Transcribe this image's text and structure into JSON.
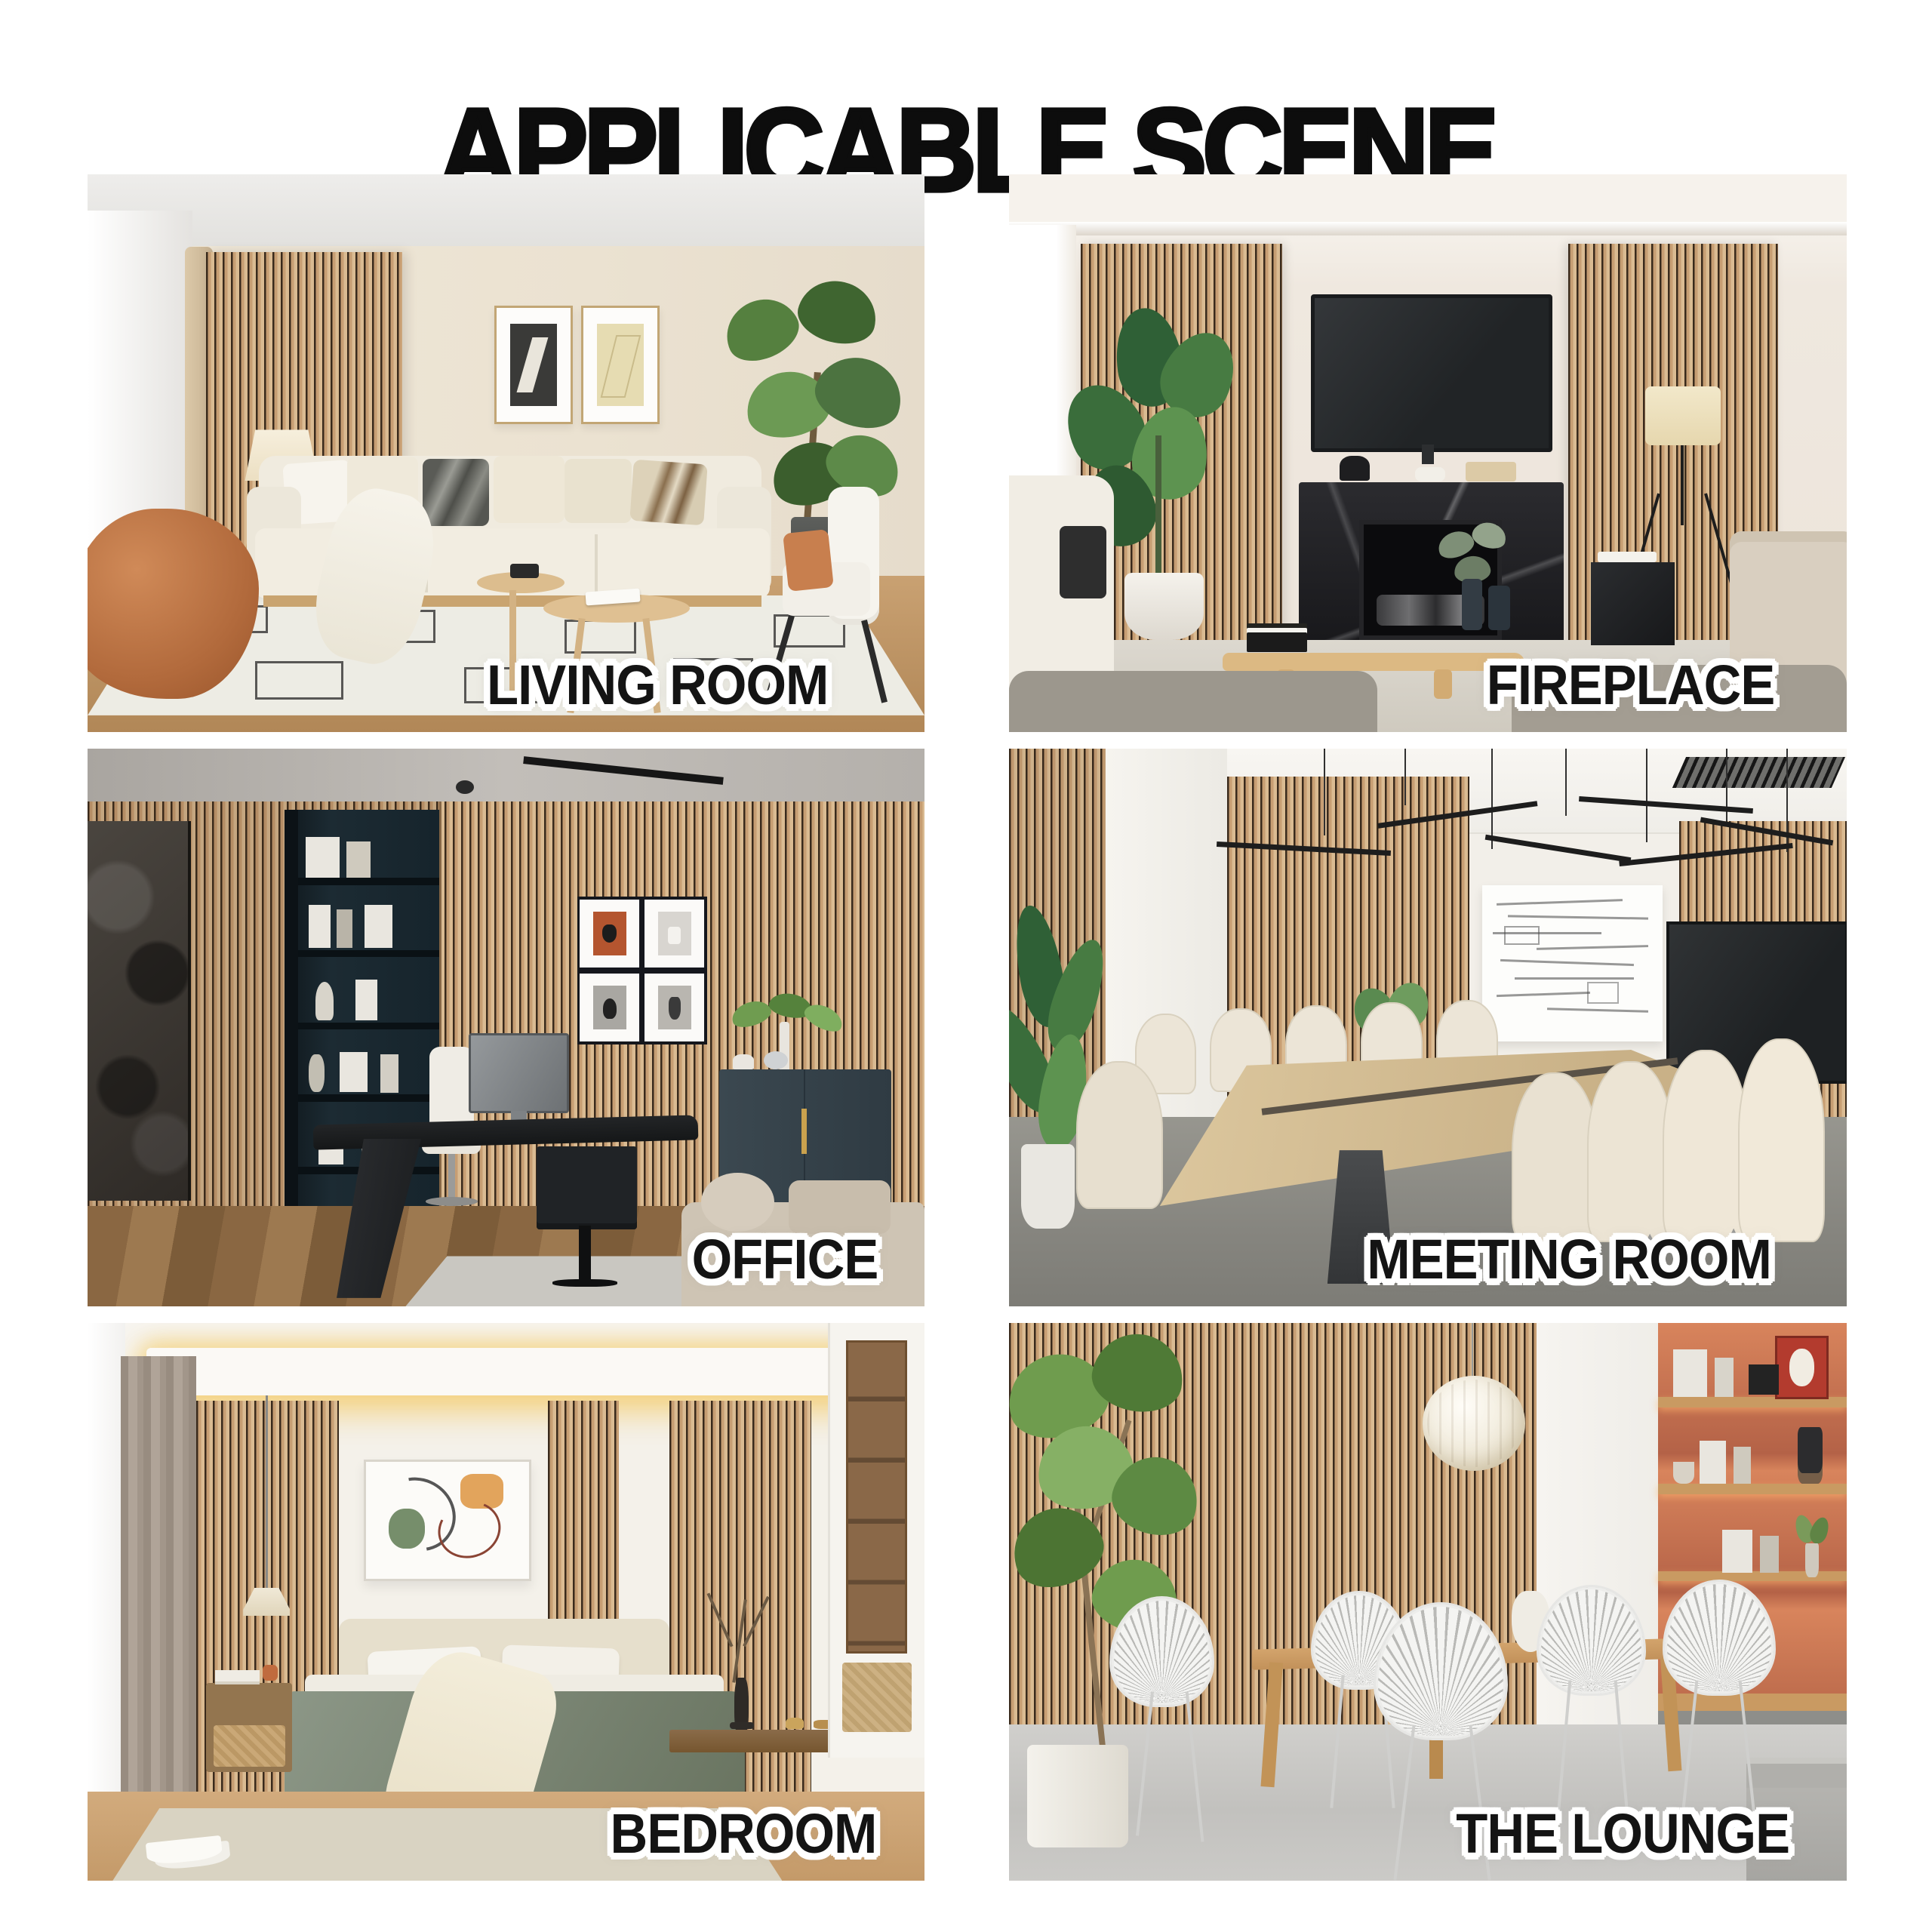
{
  "title": "APPLICABLE SCENE",
  "colors": {
    "page_background": "#ffffff",
    "title_color": "#0d0d0d",
    "label_color": "#141414",
    "label_outline": "#ffffff",
    "wood_slat": "#c79e73",
    "slat_gap": "#392a1c",
    "accent_terracotta": "#bd6a4d"
  },
  "panels": [
    {
      "id": "living-room",
      "label": "LIVING ROOM",
      "description": "living room with wood slat accent wall, sheer curtain, floor lamp, two framed artworks, cream sofa with pillows, tall plant, round wood coffee tables, geometric rug, orange bean bag"
    },
    {
      "id": "fireplace",
      "label": "FIREPLACE",
      "description": "lounge wall with two wood slat panels flanking a mounted TV above a black marble fireplace, large green plant, floor lamp, beige armchairs and wood coffee table"
    },
    {
      "id": "office",
      "label": "OFFICE",
      "description": "home office fully clad in wood slat panels with dark stone art, teal bookshelf, four framed prints, black designer desk, white chair, monitor, blue cabinet and beige sofa"
    },
    {
      "id": "meeting-room",
      "label": "MEETING ROOM",
      "description": "conference room with wood slat walls, black linear pendant lights, whiteboard with equations, wall TV, long wood meeting table with white chairs on gray carpet"
    },
    {
      "id": "bedroom",
      "label": "BEDROOM",
      "description": "bedroom with cove-lit ceiling, wood slat wall strips, abstract artwork, beige headboard, bed with sage green blanket, nightstand, pendant lamp and wardrobe"
    },
    {
      "id": "the-lounge",
      "label": "THE LOUNGE",
      "description": "dining lounge with full wood slat wall, white pleated pendant lamp, wood table with white fan-back chairs, indoor tree and terracotta shelving niche"
    }
  ]
}
